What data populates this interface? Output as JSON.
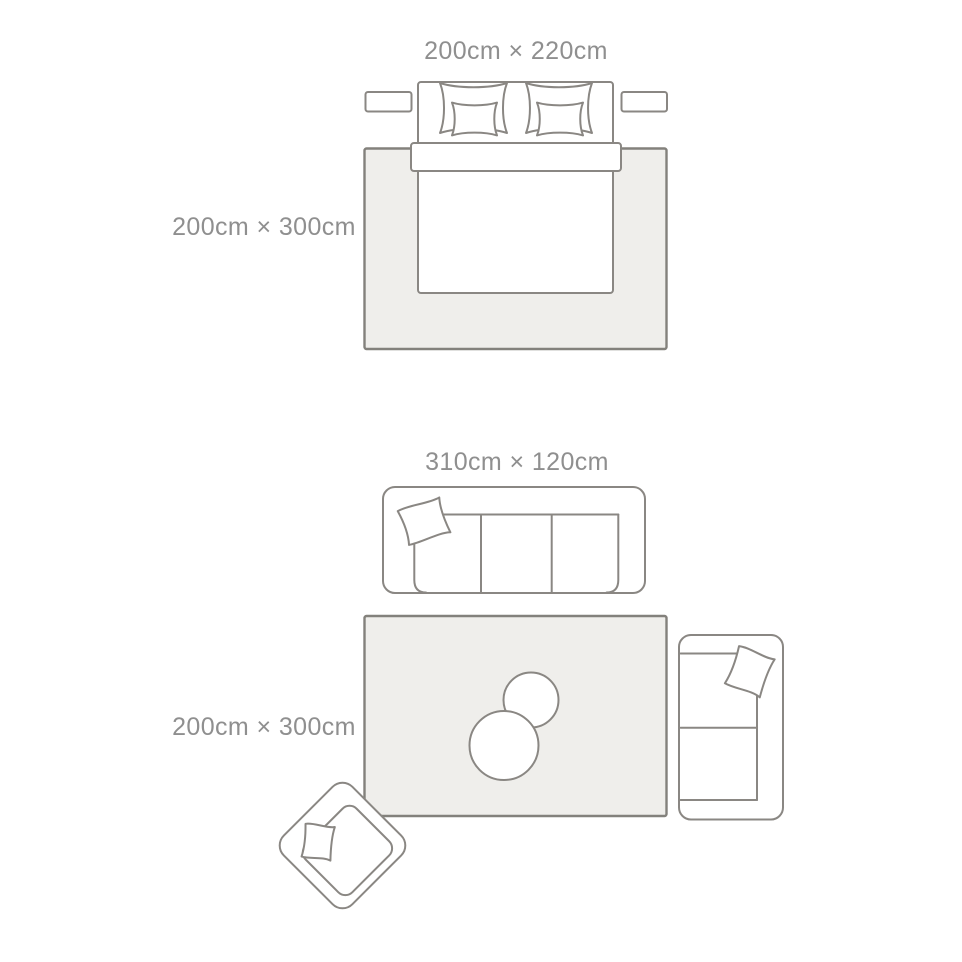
{
  "scenes": {
    "bedroom": {
      "furniture_size_label": "200cm × 220cm",
      "rug_size_label": "200cm × 300cm"
    },
    "living_room": {
      "furniture_size_label": "310cm × 120cm",
      "rug_size_label": "200cm × 300cm"
    }
  },
  "colors": {
    "line": "#8a8783",
    "rug_border": "#83817c",
    "rug_fill": "#efeeeb",
    "text": "#8f8f8f",
    "background": "#ffffff"
  }
}
